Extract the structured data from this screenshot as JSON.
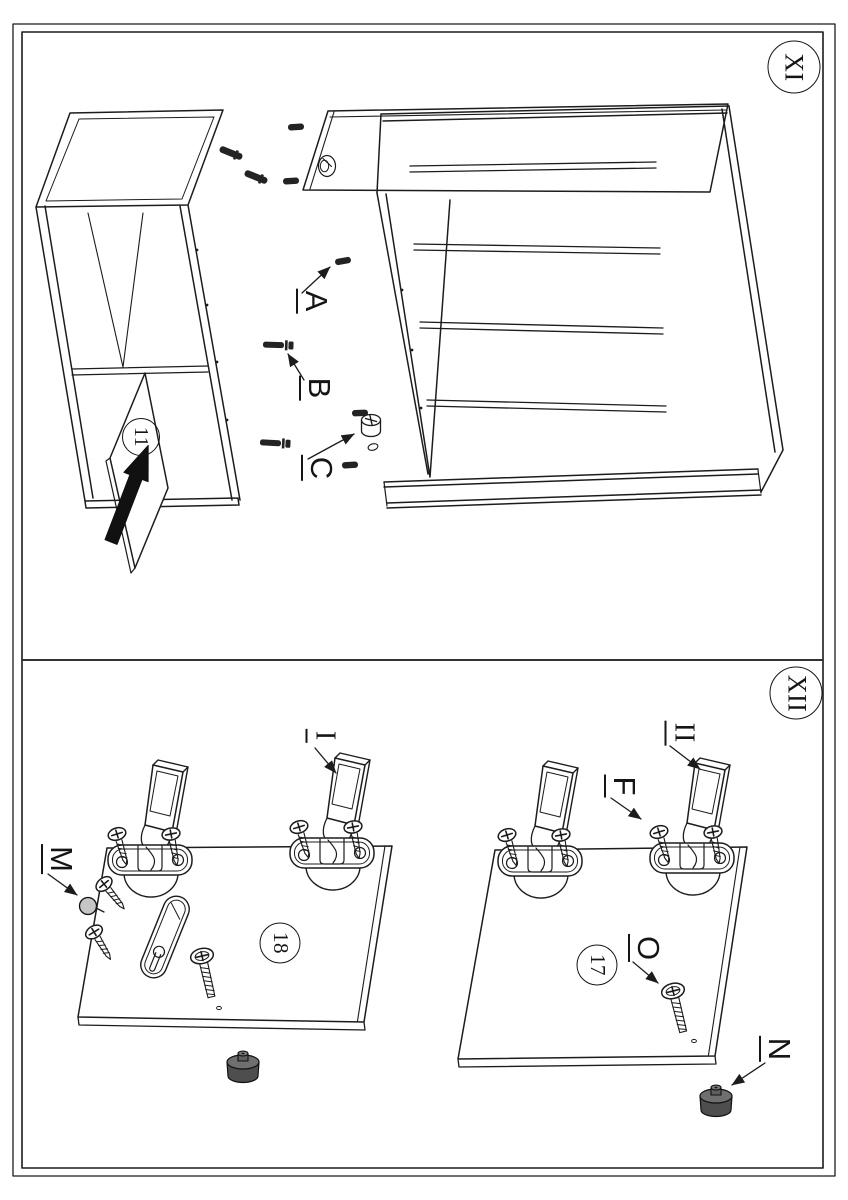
{
  "page": {
    "kind": "furniture-assembly-instruction-sheet",
    "orientation": "landscape-sheet-rotated-90deg",
    "background": "#ffffff",
    "line_color": "#1c1c1c",
    "divider_color": "#333333"
  },
  "colors": {
    "hardware_dark": "#232323",
    "foot_body": "#4e4e4e",
    "foot_top": "#6f6f6f",
    "knob_gray": "#c6c6c6"
  },
  "section_xi": {
    "badge": "XI",
    "part": "11",
    "hardware": {
      "a": "A",
      "b": "B",
      "c": "C"
    }
  },
  "section_xii": {
    "badge": "XII",
    "parts": {
      "left": "18",
      "right": "17"
    },
    "hardware": {
      "m": "M",
      "i": "I",
      "f": "F",
      "ii": "II",
      "o": "O",
      "n": "N"
    }
  }
}
